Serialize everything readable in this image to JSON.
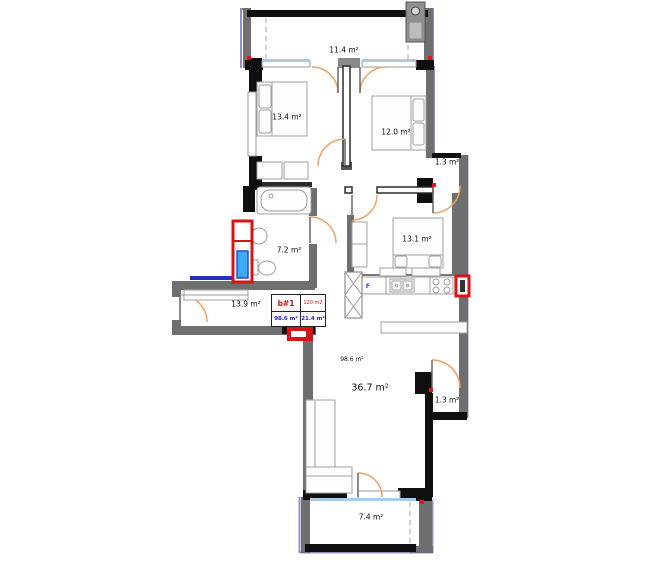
{
  "unit_table": {
    "unit_id": "b#1",
    "total_area": "120 m2",
    "indoor_area": "98.6 m²",
    "outdoor_area": "21.4 m²"
  },
  "labels": {
    "balcony_top": "11.4 m²",
    "bedroom_left": "13.4 m²",
    "bedroom_right": "12.0 m²",
    "loggia_upper": "1.3 m²",
    "bathroom": "7.2 m²",
    "bedroom_mid": "13.1 m²",
    "hallway": "13.9 m²",
    "indoor_total": "98.6 m²",
    "living_room": "36.7 m²",
    "loggia_lower": "1.3 m²",
    "balcony_bottom": "7.4 m²",
    "fridge": "F"
  },
  "colors": {
    "wall_black": "#0f0f0f",
    "wall_gray": "#6f6f6f",
    "insulation_purple": "#9191c8",
    "door_arc_orange": "#efa263",
    "accent_red": "#d61414",
    "shaft_blue": "#3fa9f5",
    "sill_blue": "#a9cbe6",
    "pipe_blue": "#2233bb"
  }
}
